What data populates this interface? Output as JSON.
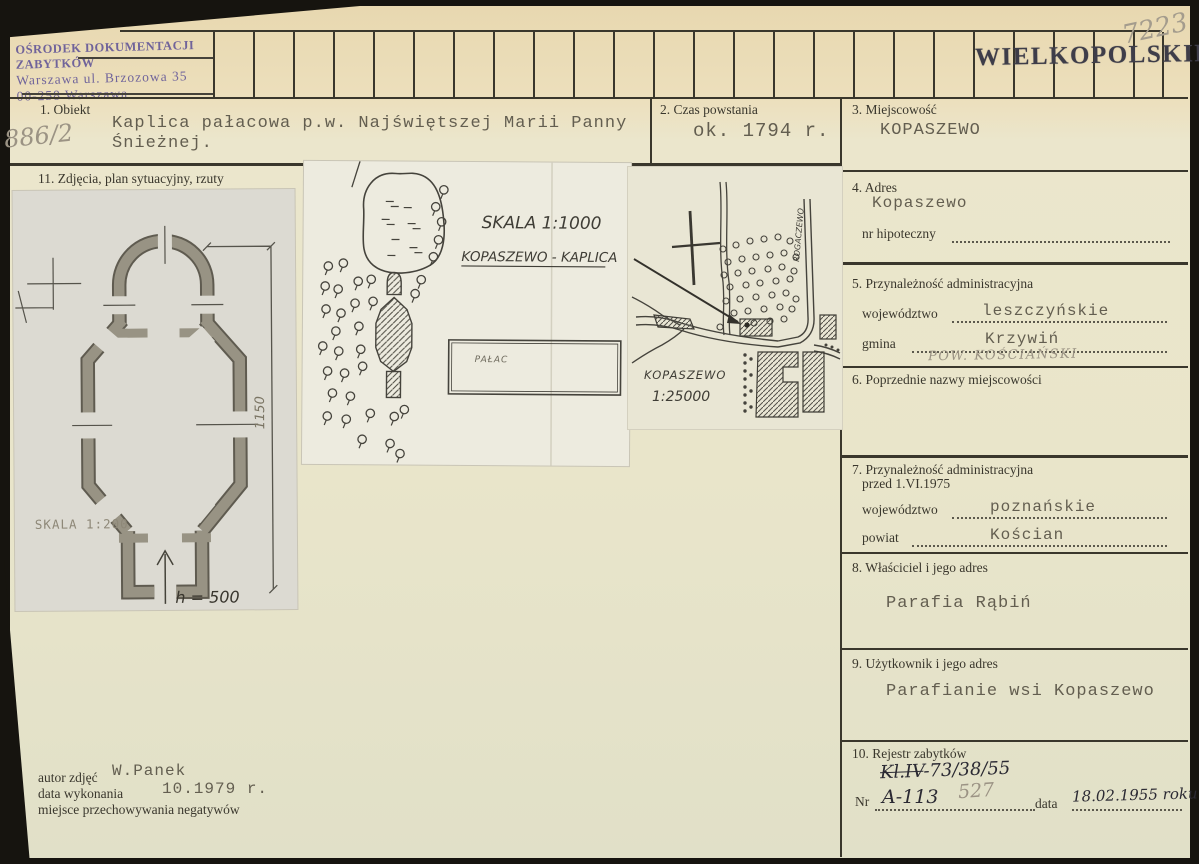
{
  "card": {
    "header": {
      "stamp_line1": "OŚRODEK DOKUMENTACJI ZABYTKÓW",
      "stamp_line2": "Warszawa ul. Brzozowa 35",
      "stamp_line3": "00-258 Warszawa",
      "region": "WIELKOPOLSKIE",
      "pencil_number": "7223"
    },
    "margin_number": "886/2",
    "fields": {
      "f1": {
        "label": "1. Obiekt",
        "value_line1": "Kaplica pałacowa p.w. Najświętszej Marii Panny",
        "value_line2": "Śnieżnej."
      },
      "f2": {
        "label": "2. Czas powstania",
        "value": "ok. 1794 r."
      },
      "f3": {
        "label": "3. Miejscowość",
        "value": "KOPASZEWO"
      },
      "f4": {
        "label": "4. Adres",
        "value": "Kopaszewo",
        "sub_label": "nr hipoteczny"
      },
      "f5": {
        "label": "5. Przynależność administracyjna",
        "wojewodztwo_label": "województwo",
        "wojewodztwo": "leszczyńskie",
        "gmina_label": "gmina",
        "gmina": "Krzywiń",
        "pencil_note": "POW. KOŚCIAŃSKI"
      },
      "f6": {
        "label": "6. Poprzednie nazwy miejscowości"
      },
      "f7": {
        "label_line1": "7. Przynależność administracyjna",
        "label_line2": "przed 1.VI.1975",
        "wojewodztwo_label": "województwo",
        "wojewodztwo": "poznańskie",
        "powiat_label": "powiat",
        "powiat": "Kościan"
      },
      "f8": {
        "label": "8. Właściciel i jego adres",
        "value": "Parafia Rąbiń"
      },
      "f9": {
        "label": "9. Użytkownik i jego adres",
        "value": "Parafianie wsi Kopaszewo"
      },
      "f10": {
        "label": "10. Rejestr zabytków",
        "reg_old_prefix": "Kl.IV",
        "reg_old_rest": "-73/38/55",
        "nr_label": "Nr",
        "nr_value": "A-113",
        "nr_pencil": "527",
        "data_label": "data",
        "data_value": "18.02.1955 roku"
      },
      "f11": {
        "label": "11. Zdjęcia, plan sytuacyjny, rzuty"
      }
    },
    "photo_credits": {
      "autor_label": "autor zdjęć",
      "autor": "W.Panek",
      "data_label": "data wykonania",
      "data": "10.1979 r.",
      "negatywy_label": "miejsce przechowywania negatywów"
    },
    "drawings": {
      "floorplan": {
        "scale": "SKALA 1:200",
        "height_note": "h = 500",
        "dim_vertical": "1150"
      },
      "siteplan": {
        "scale": "SKALA 1:1000",
        "title": "KOPASZEWO - KAPLICA",
        "palace_label": "PAŁAC"
      },
      "map": {
        "name": "KOPASZEWO",
        "scale": "1:25000",
        "road_label": "ROGACZEWO"
      }
    }
  }
}
